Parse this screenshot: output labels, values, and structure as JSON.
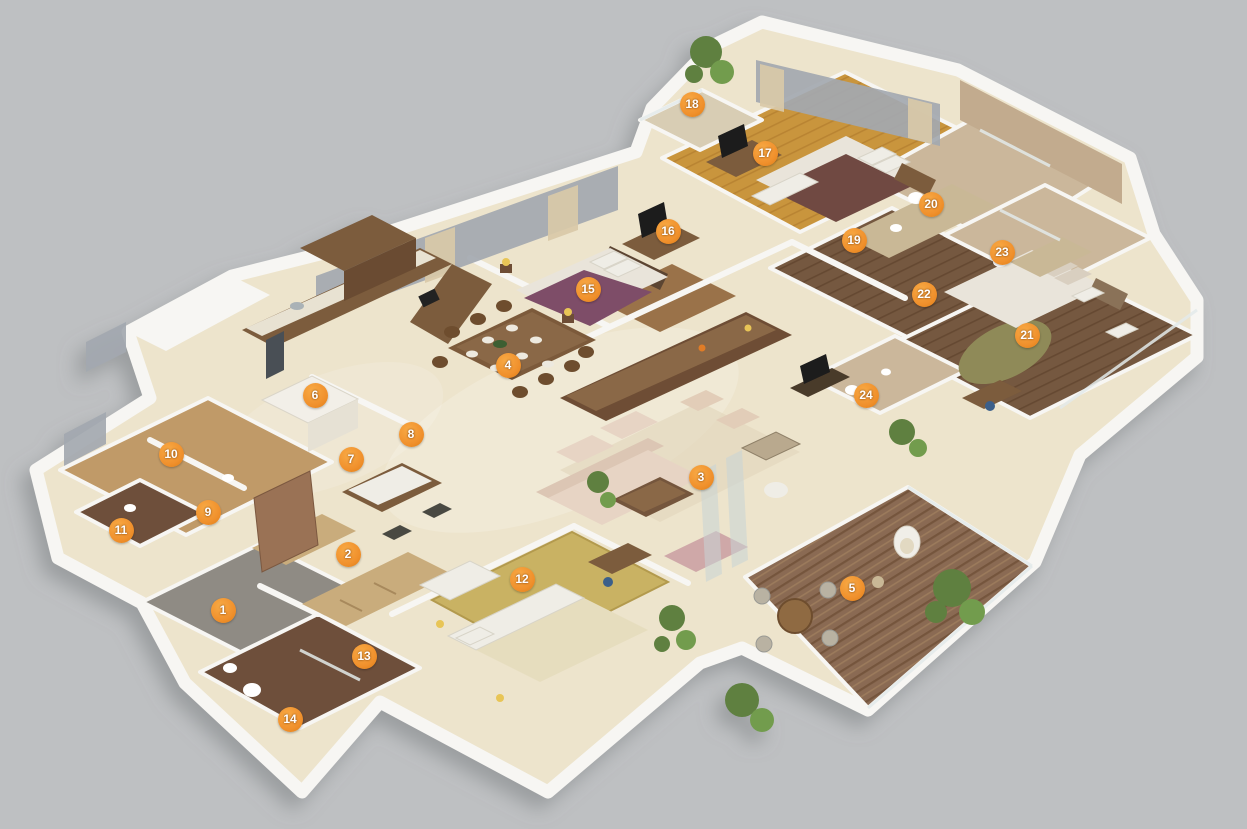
{
  "scene": {
    "description": "Isometric 3D apartment floor plan render with numbered room markers",
    "palette": {
      "bg": "#BEC0C2",
      "wall": "#F7F6F3",
      "cream": "#EDE4CC",
      "marker": "#F0902C",
      "markerText": "#FFFFFF"
    },
    "marker_count": "24"
  },
  "markers": [
    {
      "label": "1",
      "x": 223,
      "y": 610
    },
    {
      "label": "2",
      "x": 348,
      "y": 554
    },
    {
      "label": "3",
      "x": 701,
      "y": 477
    },
    {
      "label": "4",
      "x": 508,
      "y": 365
    },
    {
      "label": "5",
      "x": 852,
      "y": 588
    },
    {
      "label": "6",
      "x": 315,
      "y": 395
    },
    {
      "label": "7",
      "x": 351,
      "y": 459
    },
    {
      "label": "8",
      "x": 411,
      "y": 434
    },
    {
      "label": "9",
      "x": 208,
      "y": 512
    },
    {
      "label": "10",
      "x": 171,
      "y": 454
    },
    {
      "label": "11",
      "x": 121,
      "y": 530
    },
    {
      "label": "12",
      "x": 522,
      "y": 579
    },
    {
      "label": "13",
      "x": 364,
      "y": 656
    },
    {
      "label": "14",
      "x": 290,
      "y": 719
    },
    {
      "label": "15",
      "x": 588,
      "y": 289
    },
    {
      "label": "16",
      "x": 668,
      "y": 231
    },
    {
      "label": "17",
      "x": 765,
      "y": 153
    },
    {
      "label": "18",
      "x": 692,
      "y": 104
    },
    {
      "label": "19",
      "x": 854,
      "y": 240
    },
    {
      "label": "20",
      "x": 931,
      "y": 204
    },
    {
      "label": "21",
      "x": 1027,
      "y": 335
    },
    {
      "label": "22",
      "x": 924,
      "y": 294
    },
    {
      "label": "23",
      "x": 1002,
      "y": 252
    },
    {
      "label": "24",
      "x": 866,
      "y": 395
    }
  ]
}
